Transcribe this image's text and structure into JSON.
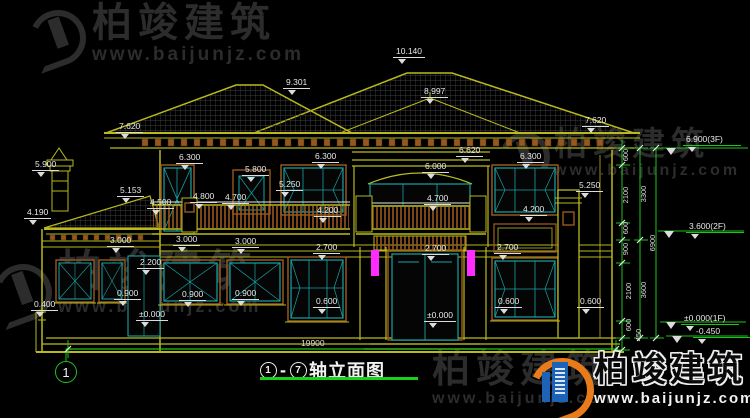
{
  "drawing": {
    "title_axis_from": "1",
    "title_axis_to": "7",
    "title_dash": "-",
    "title_name": "轴立面图",
    "axis_bubble": "1",
    "total_width_dim": "19900"
  },
  "watermark": {
    "brand": "柏竣建筑",
    "url": "www.baijunjz.com"
  },
  "logo": {
    "brand": "柏竣建筑",
    "url": "www.baijunjz.com"
  },
  "colors": {
    "background": "#000000",
    "building_line": "#b9b91e",
    "window_frame": "#17a3a3",
    "wood_trim": "#96581e",
    "dimension_green": "#1dc41d",
    "lamp_magenta": "#ff2bff",
    "text_white": "#e8e8e8"
  },
  "facade_markers": [
    {
      "label": "10.140",
      "x": 393,
      "y": 41
    },
    {
      "label": "9.301",
      "x": 283,
      "y": 72
    },
    {
      "label": "8.997",
      "x": 421,
      "y": 81
    },
    {
      "label": "7.620",
      "x": 116,
      "y": 116
    },
    {
      "label": "7.620",
      "x": 582,
      "y": 110
    },
    {
      "label": "6.300",
      "x": 176,
      "y": 147
    },
    {
      "label": "6.300",
      "x": 312,
      "y": 146
    },
    {
      "label": "6.620",
      "x": 456,
      "y": 140
    },
    {
      "label": "6.300",
      "x": 517,
      "y": 146
    },
    {
      "label": "6.000",
      "x": 422,
      "y": 156
    },
    {
      "label": "5.900",
      "x": 32,
      "y": 154
    },
    {
      "label": "5.800",
      "x": 242,
      "y": 159
    },
    {
      "label": "5.250",
      "x": 276,
      "y": 174
    },
    {
      "label": "5.153",
      "x": 117,
      "y": 180
    },
    {
      "label": "4.800",
      "x": 190,
      "y": 186
    },
    {
      "label": "4.700",
      "x": 222,
      "y": 187
    },
    {
      "label": "4.500",
      "x": 147,
      "y": 192
    },
    {
      "label": "4.190",
      "x": 24,
      "y": 202
    },
    {
      "label": "4.700",
      "x": 424,
      "y": 188
    },
    {
      "label": "4.200",
      "x": 314,
      "y": 200
    },
    {
      "label": "4.200",
      "x": 520,
      "y": 199
    },
    {
      "label": "5.250",
      "x": 576,
      "y": 175
    },
    {
      "label": "3.000",
      "x": 107,
      "y": 230
    },
    {
      "label": "3.000",
      "x": 173,
      "y": 229
    },
    {
      "label": "3.000",
      "x": 232,
      "y": 231
    },
    {
      "label": "2.700",
      "x": 313,
      "y": 237
    },
    {
      "label": "2.700",
      "x": 422,
      "y": 238
    },
    {
      "label": "2.700",
      "x": 494,
      "y": 237
    },
    {
      "label": "2.200",
      "x": 137,
      "y": 252
    },
    {
      "label": "0.900",
      "x": 114,
      "y": 283
    },
    {
      "label": "0.900",
      "x": 179,
      "y": 284
    },
    {
      "label": "0.900",
      "x": 232,
      "y": 283
    },
    {
      "label": "0.600",
      "x": 313,
      "y": 291
    },
    {
      "label": "0.600",
      "x": 495,
      "y": 291
    },
    {
      "label": "0.600",
      "x": 577,
      "y": 291
    },
    {
      "label": "0.400",
      "x": 31,
      "y": 294
    },
    {
      "label": "±0.000",
      "x": 136,
      "y": 304
    },
    {
      "label": "±0.000",
      "x": 424,
      "y": 305
    }
  ],
  "right_markers": [
    {
      "label": "6.900(3F)",
      "x": 683,
      "y": 129
    },
    {
      "label": "3.600(2F)",
      "x": 686,
      "y": 216
    },
    {
      "label": "±0.000(1F)",
      "x": 681,
      "y": 308
    },
    {
      "label": "-0.450",
      "x": 693,
      "y": 321
    }
  ],
  "chain_labels": [
    {
      "label": "600",
      "x": 621,
      "y": 172
    },
    {
      "label": "2100",
      "x": 621,
      "y": 212
    },
    {
      "label": "3300",
      "x": 639,
      "y": 211
    },
    {
      "label": "600",
      "x": 621,
      "y": 245
    },
    {
      "label": "900",
      "x": 621,
      "y": 266
    },
    {
      "label": "6900",
      "x": 648,
      "y": 260
    },
    {
      "label": "2100",
      "x": 624,
      "y": 308
    },
    {
      "label": "3600",
      "x": 639,
      "y": 307
    },
    {
      "label": "600",
      "x": 624,
      "y": 342
    },
    {
      "label": "450",
      "x": 634,
      "y": 352
    }
  ]
}
